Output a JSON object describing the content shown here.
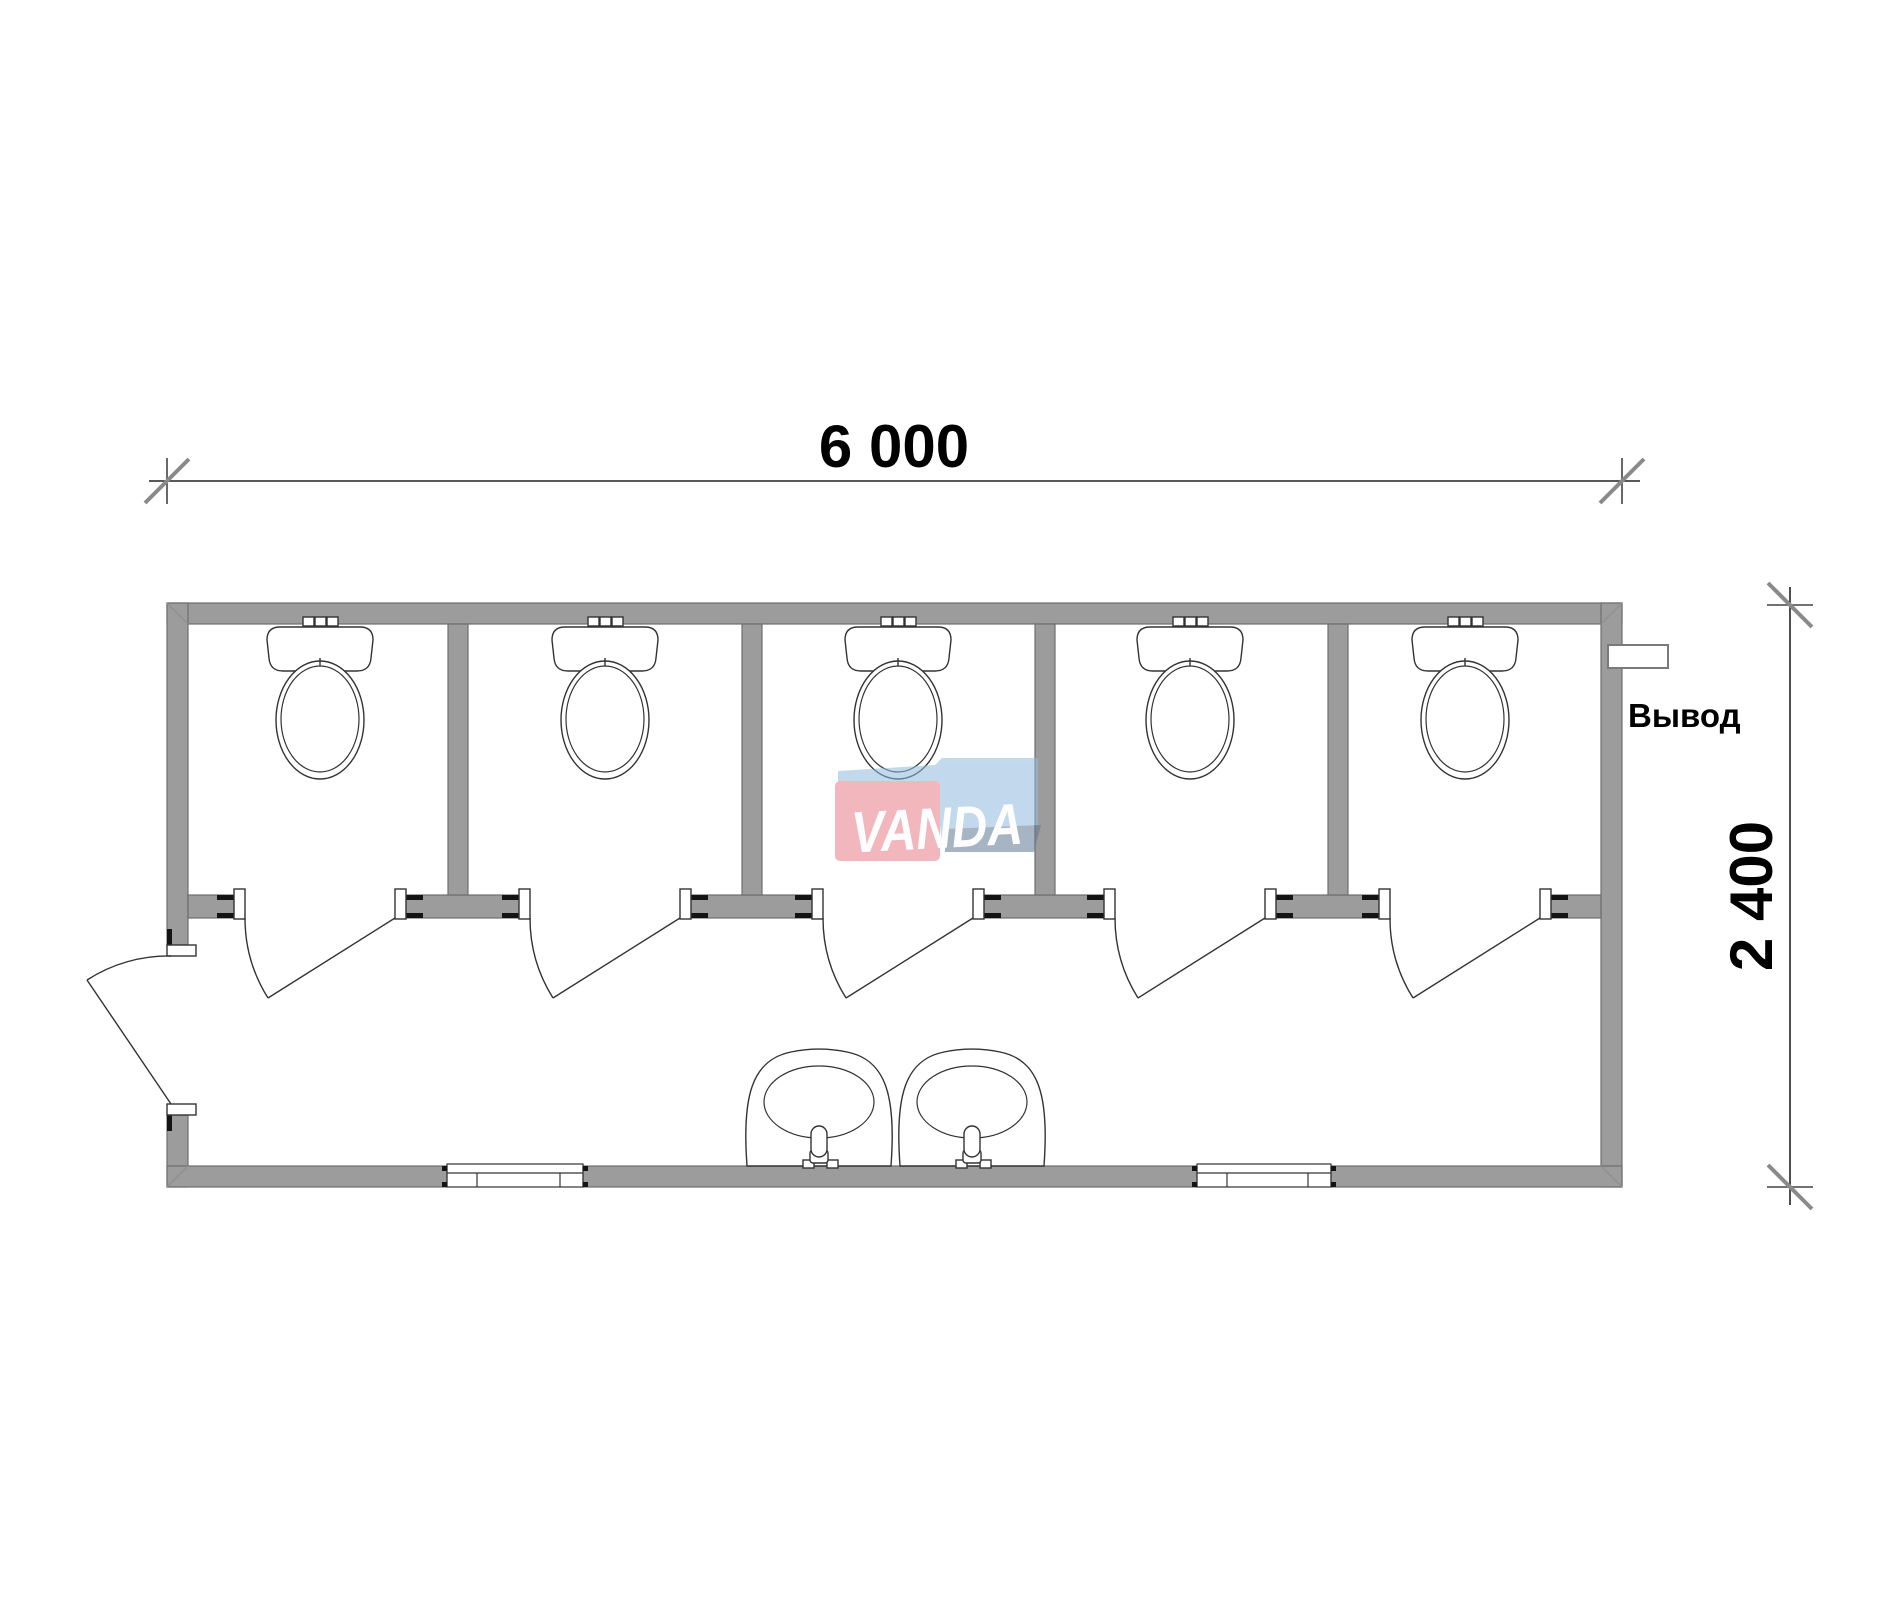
{
  "page": {
    "background": "#ffffff",
    "description": "Floor plan of a 6000x2400 mm modular sanitary container with five toilet stalls, two washbasins, two windows and an entry door"
  },
  "dimensions": {
    "horizontal": {
      "label": "6 000",
      "value_mm": 6000
    },
    "vertical": {
      "label": "2 400",
      "value_mm": 2400
    }
  },
  "labels": {
    "outlet": "Вывод"
  },
  "watermark": {
    "text": "VANDA",
    "opacity": 0.55,
    "colors": {
      "red": "#e87d87",
      "light_blue": "#92bae0",
      "slate_blue": "#617794",
      "text": "#fdfdfd"
    }
  },
  "colors": {
    "wall_fill": "#9c9c9c",
    "wall_edge": "#6f6f6f",
    "drawing_line": "#333333",
    "end_cap": "#141414",
    "dimension_slash": "#8a8a8a",
    "text": "#000000"
  },
  "plan": {
    "stall_count": 5,
    "toilet_count": 5,
    "sink_count": 2,
    "window_count": 2,
    "door_count": 6,
    "building_px": {
      "x": 167,
      "y": 603,
      "w": 1455,
      "h": 584,
      "wall_thickness": 21
    },
    "stall_centers_px": [
      320,
      605,
      898,
      1190,
      1465
    ],
    "partitions_x_px": [
      448,
      742,
      1035,
      1328
    ],
    "sink_centers_px": [
      819,
      972
    ],
    "windows_x_px": [
      [
        447,
        583
      ],
      [
        1197,
        1331
      ]
    ]
  }
}
